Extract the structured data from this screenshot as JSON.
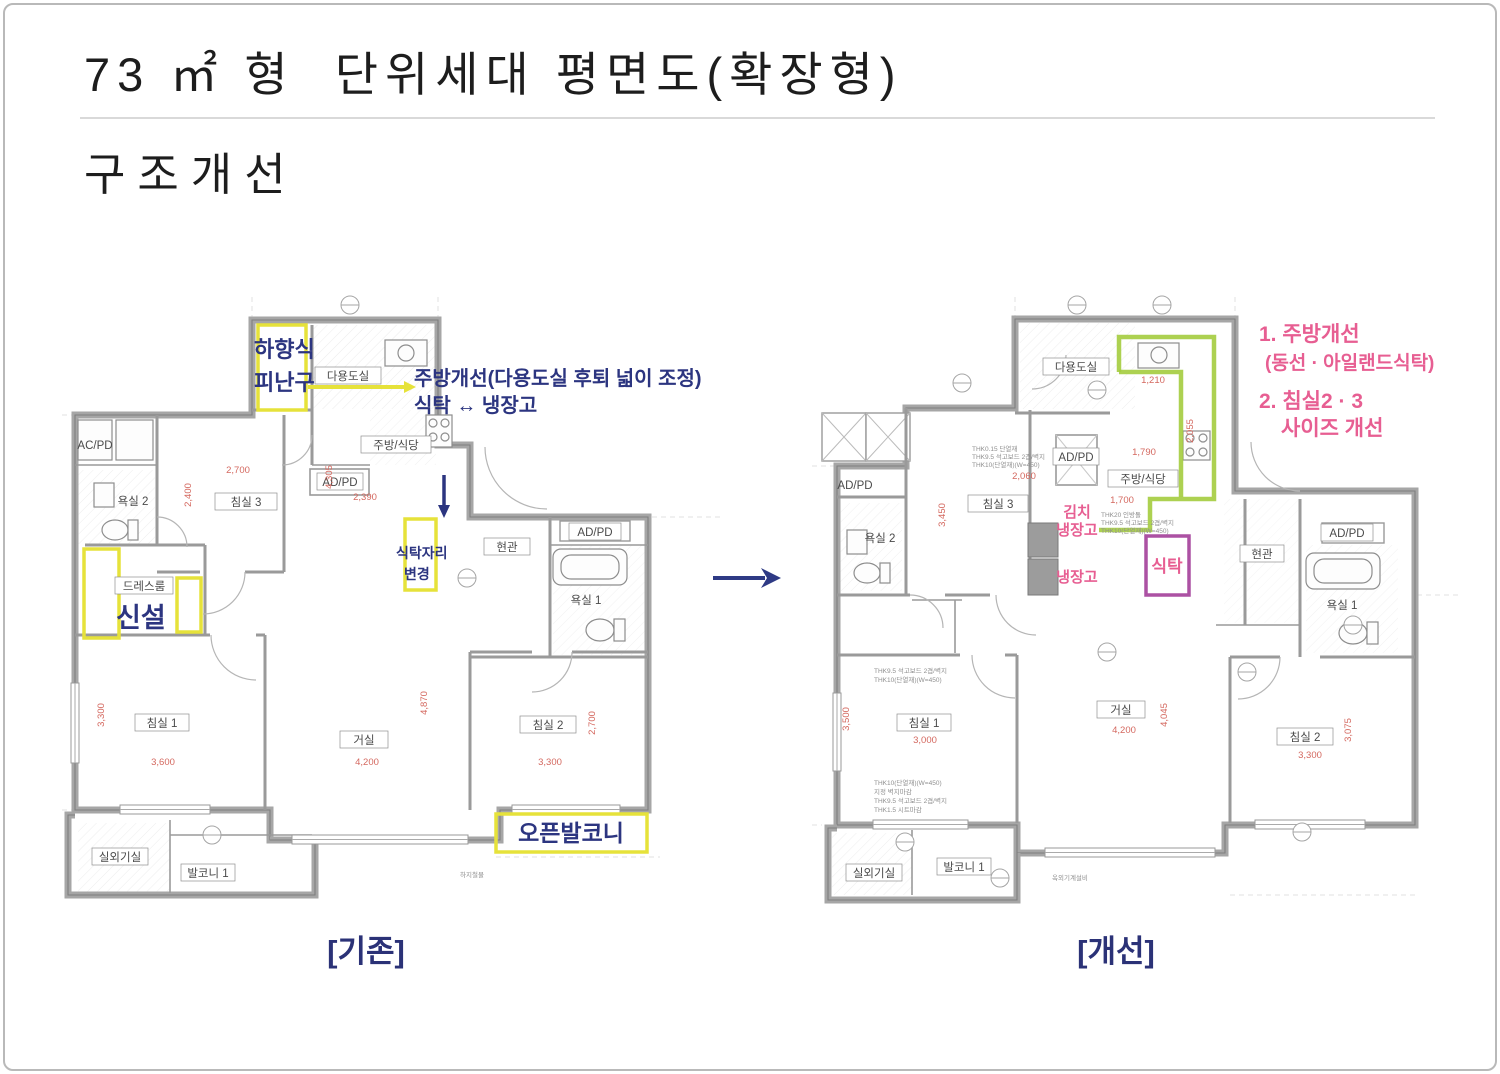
{
  "slide": {
    "title": "73 ㎡ 형  단위세대 평면도(확장형)",
    "subtitle": "구조개선",
    "left_caption": "[기존]",
    "right_caption": "[개선]"
  },
  "colors": {
    "navy": "#2c3580",
    "pink": "#e75e92",
    "yellow": "#e6e23a",
    "green": "#a4cc3e",
    "purple": "#ac51a3",
    "dim_red": "#d4685f"
  },
  "left_plan": {
    "annotations": {
      "escape1": "하향식",
      "escape2": "피난구",
      "kitchen": "주방개선(다용도실 후퇴 넓이 조정)",
      "table_fridge": "식탁 ↔ 냉장고",
      "new_install": "신설",
      "table_move1": "식탁자리",
      "table_move2": "변경",
      "open_balcony": "오픈발코니"
    },
    "room_labels": [
      {
        "x": 288,
        "y": 81,
        "w": 66,
        "t": "다용도실"
      },
      {
        "x": 336,
        "y": 150,
        "w": 70,
        "t": "주방/식당"
      },
      {
        "x": 280,
        "y": 187,
        "w": 46,
        "t": "AD/PD"
      },
      {
        "x": 35,
        "y": 150,
        "w": 38,
        "t": "AC/PD",
        "box": false
      },
      {
        "x": 73,
        "y": 206,
        "w": 44,
        "t": "욕실 2",
        "box": false
      },
      {
        "x": 186,
        "y": 207,
        "w": 62,
        "t": "침실 3"
      },
      {
        "x": 84,
        "y": 291,
        "w": 58,
        "t": "드레스룸"
      },
      {
        "x": 447,
        "y": 252,
        "w": 46,
        "t": "현관"
      },
      {
        "x": 535,
        "y": 237,
        "w": 52,
        "t": "AD/PD"
      },
      {
        "x": 526,
        "y": 305,
        "w": 42,
        "t": "욕실 1",
        "box": false
      },
      {
        "x": 102,
        "y": 428,
        "w": 54,
        "t": "침실 1"
      },
      {
        "x": 304,
        "y": 445,
        "w": 48,
        "t": "거실"
      },
      {
        "x": 488,
        "y": 430,
        "w": 56,
        "t": "침실 2"
      },
      {
        "x": 60,
        "y": 562,
        "w": 56,
        "t": "실외기실"
      },
      {
        "x": 148,
        "y": 578,
        "w": 54,
        "t": "발코니 1"
      }
    ],
    "dims": [
      {
        "x": 178,
        "y": 178,
        "t": "2,700"
      },
      {
        "x": 131,
        "y": 200,
        "t": "2,400",
        "rot": -90
      },
      {
        "x": 305,
        "y": 205,
        "t": "2,390"
      },
      {
        "x": 272,
        "y": 182,
        "t": "4,305",
        "rot": -90
      },
      {
        "x": 44,
        "y": 420,
        "t": "3,300",
        "rot": -90
      },
      {
        "x": 103,
        "y": 470,
        "t": "3,600"
      },
      {
        "x": 307,
        "y": 470,
        "t": "4,200"
      },
      {
        "x": 367,
        "y": 408,
        "t": "4,870",
        "rot": -90
      },
      {
        "x": 490,
        "y": 470,
        "t": "3,300"
      },
      {
        "x": 535,
        "y": 428,
        "t": "2,700",
        "rot": -90
      }
    ],
    "notes": [
      {
        "x": 400,
        "y": 582,
        "t": "하지철물"
      }
    ],
    "markers": [
      {
        "x": 290,
        "y": 10
      },
      {
        "x": 407,
        "y": 283
      },
      {
        "x": 152,
        "y": 540
      }
    ]
  },
  "right_plan": {
    "annotations": {
      "n1": "1. 주방개선",
      "n1b": "(동선 · 아일랜드식탁)",
      "n2": "2. 침실2 · 3",
      "n2b": "사이즈 개선",
      "kimchi1": "김치",
      "kimchi2": "냉장고",
      "fridge": "냉장고",
      "table": "식탁"
    },
    "room_labels": [
      {
        "x": 266,
        "y": 72,
        "w": 66,
        "t": "다용도실"
      },
      {
        "x": 266,
        "y": 162,
        "w": 46,
        "t": "AD/PD"
      },
      {
        "x": 333,
        "y": 184,
        "w": 70,
        "t": "주방/식당"
      },
      {
        "x": 188,
        "y": 209,
        "w": 60,
        "t": "침실 3"
      },
      {
        "x": 70,
        "y": 243,
        "w": 44,
        "t": "욕실 2",
        "box": false
      },
      {
        "x": 45,
        "y": 190,
        "w": 38,
        "t": "AD/PD",
        "box": false
      },
      {
        "x": 452,
        "y": 259,
        "w": 44,
        "t": "현관"
      },
      {
        "x": 537,
        "y": 238,
        "w": 52,
        "t": "AD/PD"
      },
      {
        "x": 532,
        "y": 310,
        "w": 42,
        "t": "욕실 1",
        "box": false
      },
      {
        "x": 114,
        "y": 428,
        "w": 54,
        "t": "침실 1"
      },
      {
        "x": 311,
        "y": 415,
        "w": 48,
        "t": "거실"
      },
      {
        "x": 495,
        "y": 442,
        "w": 56,
        "t": "침실 2"
      },
      {
        "x": 64,
        "y": 578,
        "w": 56,
        "t": "실외기실"
      },
      {
        "x": 154,
        "y": 572,
        "w": 54,
        "t": "발코니 1"
      }
    ],
    "dims": [
      {
        "x": 343,
        "y": 88,
        "t": "1,210"
      },
      {
        "x": 383,
        "y": 136,
        "t": "2,055",
        "rot": -90
      },
      {
        "x": 334,
        "y": 160,
        "t": "1,790"
      },
      {
        "x": 214,
        "y": 184,
        "t": "2,060"
      },
      {
        "x": 135,
        "y": 220,
        "t": "3,450",
        "rot": -90
      },
      {
        "x": 312,
        "y": 208,
        "t": "1,700"
      },
      {
        "x": 39,
        "y": 424,
        "t": "3,500",
        "rot": -90
      },
      {
        "x": 115,
        "y": 448,
        "t": "3,000"
      },
      {
        "x": 314,
        "y": 438,
        "t": "4,200"
      },
      {
        "x": 357,
        "y": 420,
        "t": "4,045",
        "rot": -90
      },
      {
        "x": 500,
        "y": 463,
        "t": "3,300"
      },
      {
        "x": 541,
        "y": 435,
        "t": "3,075",
        "rot": -90
      }
    ],
    "notes": [
      {
        "x": 162,
        "y": 156,
        "t": "THK0.15 단열재"
      },
      {
        "x": 162,
        "y": 164,
        "t": "THK9.5 석고보드 2겹/벽지"
      },
      {
        "x": 162,
        "y": 172,
        "t": "THK10(단열재)(W=450)"
      },
      {
        "x": 291,
        "y": 222,
        "t": "THK20 인방돌"
      },
      {
        "x": 291,
        "y": 230,
        "t": "THK9.5 석고보드 2겹/벽지"
      },
      {
        "x": 291,
        "y": 238,
        "t": "THK10(단열재)(W=450)"
      },
      {
        "x": 64,
        "y": 378,
        "t": "THK9.5 석고보드 2겹/벽지"
      },
      {
        "x": 64,
        "y": 387,
        "t": "THK10(단열재)(W=450)"
      },
      {
        "x": 64,
        "y": 490,
        "t": "THK10(단열재)(W=450)"
      },
      {
        "x": 64,
        "y": 499,
        "t": "지정 벽지마감"
      },
      {
        "x": 64,
        "y": 508,
        "t": "THK9.5 석고보드 2겹/벽지"
      },
      {
        "x": 64,
        "y": 517,
        "t": "THK1.5 시트마감"
      },
      {
        "x": 242,
        "y": 585,
        "t": "옥외기계설비"
      }
    ],
    "markers": [
      {
        "x": 267,
        "y": 10
      },
      {
        "x": 352,
        "y": 10
      },
      {
        "x": 152,
        "y": 88
      },
      {
        "x": 287,
        "y": 95
      },
      {
        "x": 297,
        "y": 357
      },
      {
        "x": 437,
        "y": 377
      },
      {
        "x": 190,
        "y": 583
      },
      {
        "x": 95,
        "y": 547
      },
      {
        "x": 492,
        "y": 537
      },
      {
        "x": 543,
        "y": 330
      }
    ]
  }
}
